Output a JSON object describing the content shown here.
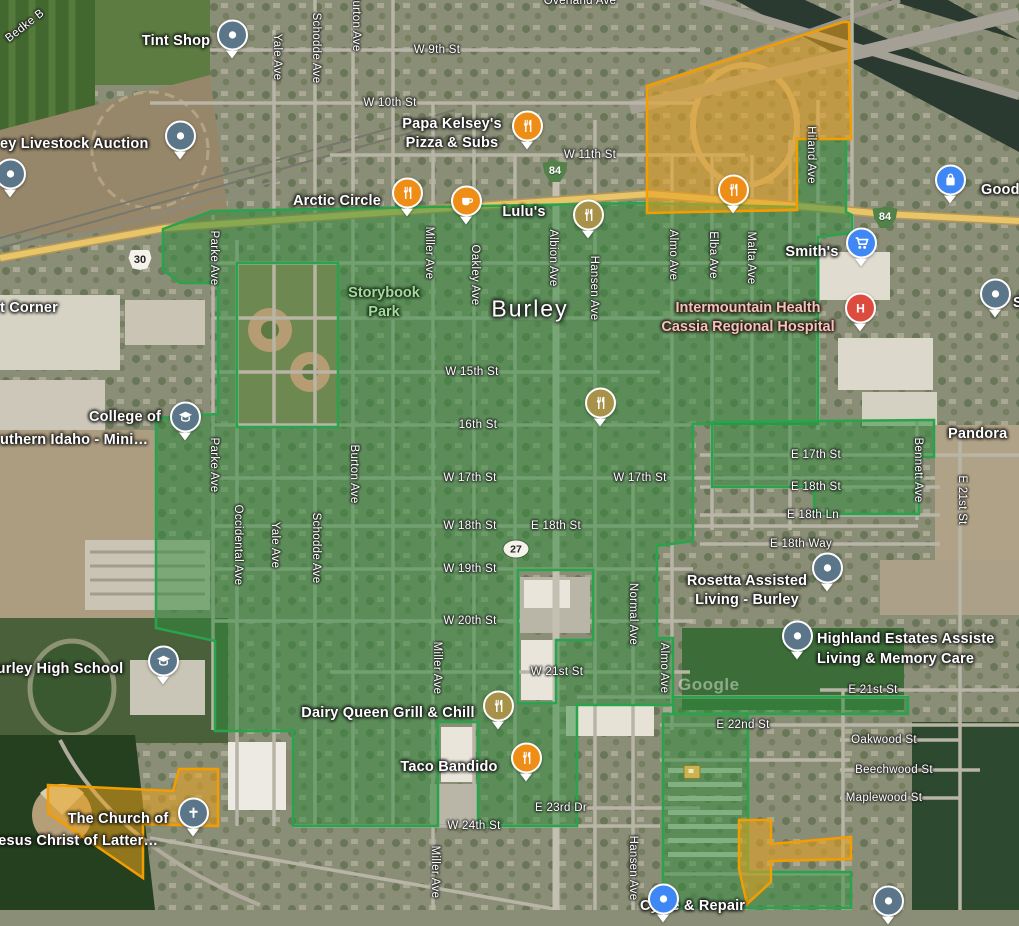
{
  "map": {
    "city": "Burley",
    "watermark": "Google",
    "overlay_colors": {
      "green_fill": "rgba(45,140,60,0.50)",
      "green_stroke": "#2aa34d",
      "orange_fill": "rgba(235,162,30,0.55)",
      "orange_stroke": "#f29d00"
    },
    "overlays": [
      {
        "name": "green-main-district",
        "d": "M163,229 L212,211 L640,203 L797,207 L797,139 L846,139 L846,212 L852,215 L852,233 L818,237 L818,424 L693,424 L693,541 L657,546 L657,638 L673,638 L673,705 L577,705 L577,826 L478,826 L478,722 L438,722 L438,826 L293,826 L293,731 L215,731 L215,641 L156,628 L156,418 L218,414 L218,283 L180,283 L163,270 Z M237,263 L338,263 L338,427 L237,427 Z M518,570 L593,570 L593,640 L556,640 L556,703 L518,703 Z",
        "color": "green"
      },
      {
        "name": "green-east-arm",
        "d": "M712,422 L934,420 L934,457 L919,457 L919,514 L814,514 L814,487 L712,487 Z",
        "color": "green"
      },
      {
        "name": "green-southeast-row",
        "d": "M673,697 L908,697 L908,714 L673,714 Z",
        "color": "green"
      },
      {
        "name": "green-southeast-parcel",
        "d": "M663,714 L748,714 L748,872 L851,872 L851,908 L663,908 Z",
        "color": "green"
      },
      {
        "name": "orange-fairgrounds",
        "d": "M647,86 L843,22 L849,22 L851,139 L797,139 L797,210 L647,213 Z",
        "color": "orange"
      },
      {
        "name": "orange-church-parcel",
        "d": "M48,785 L173,791 L179,769 L218,769 L218,826 L143,824 L143,878 L48,813 Z",
        "color": "orange"
      },
      {
        "name": "orange-south-flag",
        "d": "M739,820 L771,820 L771,844 L851,837 L851,859 L771,861 L771,882 L747,904 L739,869 Z",
        "color": "orange"
      }
    ],
    "labels": [
      {
        "t": "W 9th St",
        "x": 437,
        "y": 50,
        "c": "st"
      },
      {
        "t": "W 10th St",
        "x": 390,
        "y": 103,
        "c": "st"
      },
      {
        "t": "W 11th St",
        "x": 590,
        "y": 155,
        "c": "st"
      },
      {
        "t": "W 15th St",
        "x": 472,
        "y": 372,
        "c": "st"
      },
      {
        "t": "16th St",
        "x": 478,
        "y": 425,
        "c": "st"
      },
      {
        "t": "W 17th St",
        "x": 470,
        "y": 478,
        "c": "st"
      },
      {
        "t": "W 17th St",
        "x": 640,
        "y": 478,
        "c": "st"
      },
      {
        "t": "E 17th St",
        "x": 816,
        "y": 455,
        "c": "st"
      },
      {
        "t": "W 18th St",
        "x": 470,
        "y": 526,
        "c": "st"
      },
      {
        "t": "E 18th St",
        "x": 556,
        "y": 526,
        "c": "st"
      },
      {
        "t": "E 18th St",
        "x": 816,
        "y": 487,
        "c": "st"
      },
      {
        "t": "E 18th Ln",
        "x": 813,
        "y": 515,
        "c": "st"
      },
      {
        "t": "E 18th Way",
        "x": 801,
        "y": 544,
        "c": "st"
      },
      {
        "t": "W 19th St",
        "x": 470,
        "y": 569,
        "c": "st"
      },
      {
        "t": "W 20th St",
        "x": 470,
        "y": 621,
        "c": "st"
      },
      {
        "t": "W 21st St",
        "x": 557,
        "y": 672,
        "c": "st"
      },
      {
        "t": "E 21st St",
        "x": 873,
        "y": 690,
        "c": "st"
      },
      {
        "t": "E 22nd St",
        "x": 743,
        "y": 725,
        "c": "st"
      },
      {
        "t": "Oakwood St",
        "x": 884,
        "y": 740,
        "c": "st"
      },
      {
        "t": "Beechwood St",
        "x": 894,
        "y": 770,
        "c": "st"
      },
      {
        "t": "Maplewood St",
        "x": 884,
        "y": 798,
        "c": "st"
      },
      {
        "t": "E 23rd Dr",
        "x": 561,
        "y": 808,
        "c": "st"
      },
      {
        "t": "W 24th St",
        "x": 474,
        "y": 826,
        "c": "st"
      },
      {
        "t": "Overland Ave",
        "x": 580,
        "y": 1,
        "c": "st"
      },
      {
        "t": "Bedke B",
        "x": 25,
        "y": 26,
        "c": "st",
        "r": -38
      },
      {
        "t": "Yale Ave",
        "x": 277,
        "y": 57,
        "c": "st",
        "r": 90
      },
      {
        "t": "Schodde Ave",
        "x": 316,
        "y": 48,
        "c": "st",
        "r": 90
      },
      {
        "t": "Burton Ave",
        "x": 356,
        "y": 22,
        "c": "st",
        "r": 90
      },
      {
        "t": "Miller Ave",
        "x": 429,
        "y": 253,
        "c": "st",
        "r": 90
      },
      {
        "t": "Oakley Ave",
        "x": 475,
        "y": 275,
        "c": "st",
        "r": 90
      },
      {
        "t": "Albion Ave",
        "x": 553,
        "y": 258,
        "c": "st",
        "r": 90
      },
      {
        "t": "Hansen Ave",
        "x": 594,
        "y": 288,
        "c": "st",
        "r": 90
      },
      {
        "t": "Almo Ave",
        "x": 673,
        "y": 255,
        "c": "st",
        "r": 90
      },
      {
        "t": "Elba Ave",
        "x": 713,
        "y": 255,
        "c": "st",
        "r": 90
      },
      {
        "t": "Malta Ave",
        "x": 751,
        "y": 258,
        "c": "st",
        "r": 90
      },
      {
        "t": "Hiland Ave",
        "x": 811,
        "y": 155,
        "c": "st",
        "r": 90
      },
      {
        "t": "Parke Ave",
        "x": 214,
        "y": 258,
        "c": "st",
        "r": 90
      },
      {
        "t": "Parke Ave",
        "x": 214,
        "y": 465,
        "c": "st",
        "r": 90
      },
      {
        "t": "Occidental Ave",
        "x": 238,
        "y": 545,
        "c": "st",
        "r": 90
      },
      {
        "t": "Yale Ave",
        "x": 275,
        "y": 545,
        "c": "st",
        "r": 90
      },
      {
        "t": "Schodde Ave",
        "x": 316,
        "y": 548,
        "c": "st",
        "r": 90
      },
      {
        "t": "Burton Ave",
        "x": 354,
        "y": 474,
        "c": "st",
        "r": 90
      },
      {
        "t": "Normal Ave",
        "x": 633,
        "y": 614,
        "c": "st",
        "r": 90
      },
      {
        "t": "Almo Ave",
        "x": 664,
        "y": 668,
        "c": "st",
        "r": 90
      },
      {
        "t": "Bennett Ave",
        "x": 918,
        "y": 470,
        "c": "st",
        "r": 90
      },
      {
        "t": "E 21st St",
        "x": 962,
        "y": 500,
        "c": "st",
        "r": 90
      },
      {
        "t": "Hansen Ave",
        "x": 633,
        "y": 868,
        "c": "st",
        "r": 90
      },
      {
        "t": "Miller Ave",
        "x": 437,
        "y": 668,
        "c": "st",
        "r": 90
      },
      {
        "t": "Miller Ave",
        "x": 435,
        "y": 872,
        "c": "st",
        "r": 90
      },
      {
        "t": "Tint Shop",
        "x": 176,
        "y": 41,
        "c": "poi"
      },
      {
        "t": "ey Livestock Auction",
        "x": 0,
        "y": 144,
        "c": "poi",
        "a": "l"
      },
      {
        "lines": [
          "Papa Kelsey's",
          "Pizza & Subs"
        ],
        "x": 452,
        "y": 134,
        "c": "poi"
      },
      {
        "t": "Arctic Circle",
        "x": 337,
        "y": 201,
        "c": "poi"
      },
      {
        "t": "Lulu's",
        "x": 524,
        "y": 212,
        "c": "poi"
      },
      {
        "t": "Goode",
        "x": 981,
        "y": 190,
        "c": "poi",
        "a": "l"
      },
      {
        "t": "Smith's",
        "x": 812,
        "y": 252,
        "c": "poi"
      },
      {
        "lines": [
          "Intermountain Health",
          "Cassia Regional Hospital"
        ],
        "x": 748,
        "y": 318,
        "c": "hosp"
      },
      {
        "t": "S",
        "x": 1013,
        "y": 303,
        "c": "poi",
        "a": "l"
      },
      {
        "lines": [
          "Storybook",
          "Park"
        ],
        "x": 384,
        "y": 303,
        "c": "park"
      },
      {
        "t": "Burley",
        "x": 530,
        "y": 309,
        "c": "city"
      },
      {
        "t": "t Corner",
        "x": 0,
        "y": 308,
        "c": "poi",
        "a": "l"
      },
      {
        "t": "College of",
        "x": 125,
        "y": 417,
        "c": "poi"
      },
      {
        "t": "uthern Idaho -  Mini…",
        "x": 0,
        "y": 440,
        "c": "poi",
        "a": "l"
      },
      {
        "lines": [
          "Rosetta Assisted",
          "Living - Burley"
        ],
        "x": 747,
        "y": 591,
        "c": "poi"
      },
      {
        "t": "Highland Estates Assiste",
        "x": 817,
        "y": 639,
        "c": "poi",
        "a": "l"
      },
      {
        "t": "Living & Memory Care",
        "x": 817,
        "y": 659,
        "c": "poi",
        "a": "l"
      },
      {
        "t": "Pandora",
        "x": 948,
        "y": 434,
        "c": "poi",
        "a": "l"
      },
      {
        "t": "Burley High School",
        "x": -14,
        "y": 669,
        "c": "poi",
        "a": "l"
      },
      {
        "t": "The Church of",
        "x": 118,
        "y": 819,
        "c": "poi"
      },
      {
        "t": "Jesus Christ of Latter…",
        "x": -10,
        "y": 841,
        "c": "poi",
        "a": "l"
      },
      {
        "t": "Dairy Queen Grill & Chill",
        "x": 388,
        "y": 713,
        "c": "poi"
      },
      {
        "t": "Taco Bandido",
        "x": 449,
        "y": 767,
        "c": "poi"
      },
      {
        "t": "Cycle & Repair",
        "x": 640,
        "y": 906,
        "c": "poi",
        "a": "l"
      },
      {
        "t": "Google",
        "x": 678,
        "y": 685,
        "c": "wm",
        "a": "l"
      }
    ],
    "pins": [
      {
        "x": 232,
        "y": 42,
        "kind": "dot",
        "color": "#5b7589",
        "name": "tint-shop-pin"
      },
      {
        "x": 180,
        "y": 143,
        "kind": "dot",
        "color": "#5b7589",
        "name": "livestock-auction-pin"
      },
      {
        "x": 10,
        "y": 181,
        "kind": "dot",
        "color": "#5b7589",
        "name": "left-edge-pin"
      },
      {
        "x": 527,
        "y": 133,
        "kind": "food",
        "color": "#ef8e17",
        "name": "papa-kelseys-pin"
      },
      {
        "x": 407,
        "y": 200,
        "kind": "food",
        "color": "#ef8e17",
        "name": "arctic-circle-pin"
      },
      {
        "x": 466,
        "y": 208,
        "kind": "coffee",
        "color": "#ef8e17",
        "name": "lulus-pin"
      },
      {
        "x": 588,
        "y": 222,
        "kind": "food",
        "color": "#a8924a",
        "name": "restaurant-pin-olive-1"
      },
      {
        "x": 733,
        "y": 197,
        "kind": "food",
        "color": "#ef8e17",
        "name": "fairgrounds-restaurant-pin"
      },
      {
        "x": 950,
        "y": 187,
        "kind": "bag",
        "color": "#3f87f5",
        "name": "goode-store-pin"
      },
      {
        "x": 861,
        "y": 250,
        "kind": "cart",
        "color": "#3f87f5",
        "name": "smiths-pin"
      },
      {
        "x": 860,
        "y": 315,
        "kind": "hospital",
        "color": "#dd4b3e",
        "name": "hospital-pin"
      },
      {
        "x": 995,
        "y": 301,
        "kind": "dot",
        "color": "#5b7589",
        "name": "right-edge-pin"
      },
      {
        "x": 600,
        "y": 410,
        "kind": "food",
        "color": "#a8924a",
        "name": "restaurant-pin-olive-2"
      },
      {
        "x": 185,
        "y": 424,
        "kind": "school",
        "color": "#5b7589",
        "name": "college-pin"
      },
      {
        "x": 827,
        "y": 575,
        "kind": "dot",
        "color": "#5b7589",
        "name": "rosetta-pin"
      },
      {
        "x": 797,
        "y": 643,
        "kind": "dot",
        "color": "#5b7589",
        "name": "highland-estates-pin"
      },
      {
        "x": 163,
        "y": 668,
        "kind": "school",
        "color": "#5b7589",
        "name": "high-school-pin"
      },
      {
        "x": 193,
        "y": 820,
        "kind": "church",
        "color": "#5b7589",
        "name": "church-pin"
      },
      {
        "x": 498,
        "y": 713,
        "kind": "food",
        "color": "#a8924a",
        "name": "dairy-queen-pin"
      },
      {
        "x": 526,
        "y": 765,
        "kind": "food",
        "color": "#ef8e17",
        "name": "taco-bandido-pin"
      },
      {
        "x": 663,
        "y": 906,
        "kind": "dot",
        "color": "#3f87f5",
        "name": "bottom-edge-pin"
      },
      {
        "x": 888,
        "y": 908,
        "kind": "dot",
        "color": "#5b7589",
        "name": "bottom-right-pin"
      }
    ],
    "shields": [
      {
        "type": "interstate",
        "num": "84",
        "x": 555,
        "y": 171
      },
      {
        "type": "interstate",
        "num": "84",
        "x": 885,
        "y": 217
      },
      {
        "type": "us",
        "num": "30",
        "x": 140,
        "y": 260
      },
      {
        "type": "oval",
        "num": "27",
        "x": 516,
        "y": 549
      }
    ],
    "flag_marker": {
      "x": 692,
      "y": 772
    }
  }
}
